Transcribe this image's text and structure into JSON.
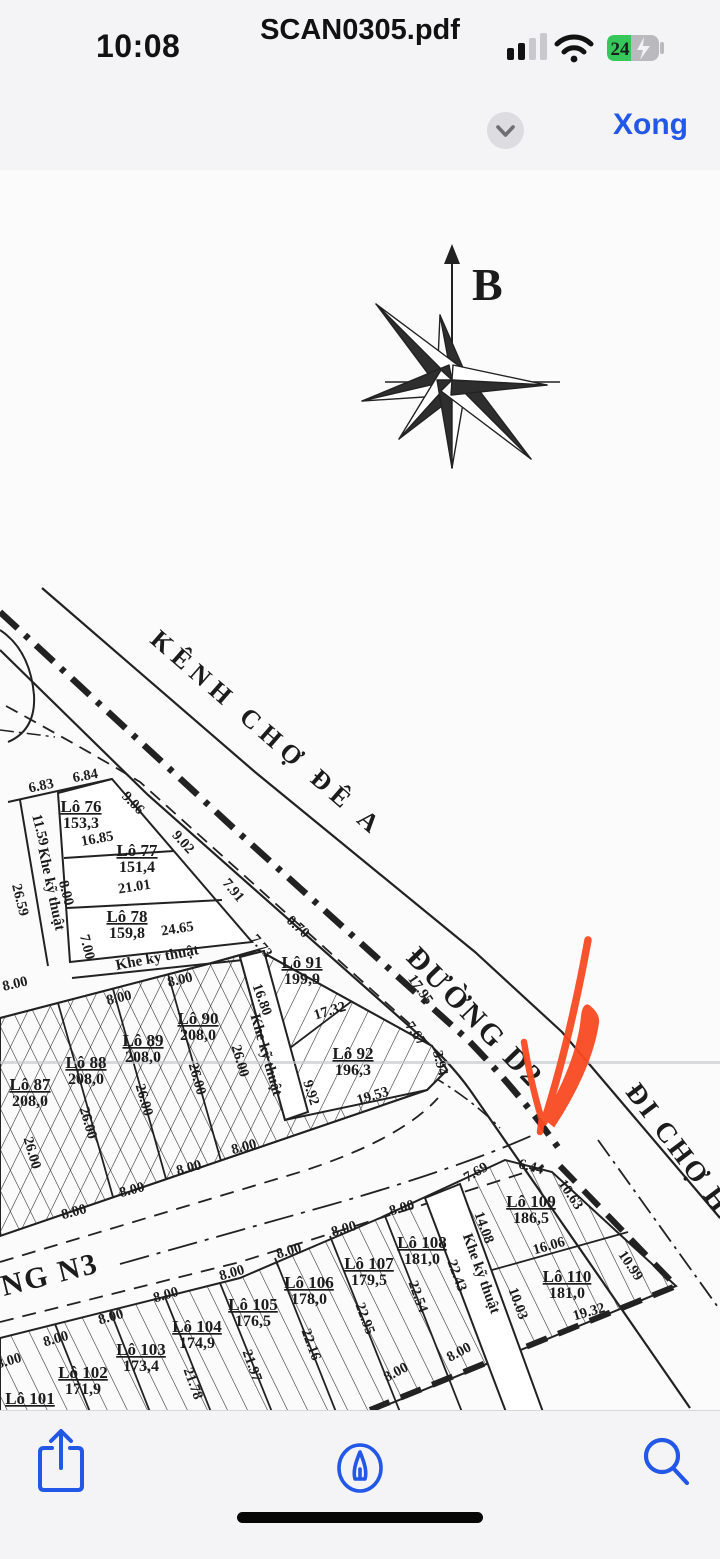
{
  "status_bar": {
    "time": "10:08",
    "battery_percent": "24"
  },
  "nav": {
    "title": "SCAN0305.pdf",
    "done_label": "Xong"
  },
  "page_indicator": {
    "label": "1 / 1"
  },
  "icons": {
    "accent_blue": "#2257e7",
    "arrow_red": "#f84b22",
    "names": [
      "sidebar-pages-icon",
      "chevron-down-icon",
      "share-icon",
      "markup-pen-icon",
      "search-icon"
    ]
  },
  "map": {
    "north": "B",
    "roads": [
      {
        "t": "KÊNH CHỢ ĐÊ A",
        "x": 262,
        "y": 740,
        "r": 41,
        "s": 26,
        "ls": 7
      },
      {
        "t": "ĐƯỜNG D2",
        "x": 468,
        "y": 1024,
        "r": 46,
        "s": 30,
        "ls": 3
      },
      {
        "t": "ĐI CHỢ HA",
        "x": 678,
        "y": 1163,
        "r": 53,
        "s": 28,
        "ls": 3
      },
      {
        "t": "NG N3",
        "x": 52,
        "y": 1284,
        "r": -14,
        "s": 30,
        "ls": 2
      }
    ],
    "plots": [
      {
        "name": "Lô 76",
        "area": "153,3",
        "x": 81,
        "y": 812
      },
      {
        "name": "Lô 77",
        "area": "151,4",
        "x": 137,
        "y": 856
      },
      {
        "name": "Lô 78",
        "area": "159,8",
        "x": 127,
        "y": 922
      },
      {
        "name": "Lô 87",
        "area": "208,0",
        "x": 30,
        "y": 1090
      },
      {
        "name": "Lô 88",
        "area": "208,0",
        "x": 86,
        "y": 1068
      },
      {
        "name": "Lô 89",
        "area": "208,0",
        "x": 143,
        "y": 1046
      },
      {
        "name": "Lô 90",
        "area": "208,0",
        "x": 198,
        "y": 1024
      },
      {
        "name": "Lô 91",
        "area": "199,9",
        "x": 302,
        "y": 968
      },
      {
        "name": "Lô 92",
        "area": "196,3",
        "x": 353,
        "y": 1059
      },
      {
        "name": "Lô 101",
        "area": "",
        "x": 30,
        "y": 1404
      },
      {
        "name": "Lô 102",
        "area": "171,9",
        "x": 83,
        "y": 1378
      },
      {
        "name": "Lô 103",
        "area": "173,4",
        "x": 141,
        "y": 1355
      },
      {
        "name": "Lô 104",
        "area": "174,9",
        "x": 197,
        "y": 1332
      },
      {
        "name": "Lô 105",
        "area": "176,5",
        "x": 253,
        "y": 1310
      },
      {
        "name": "Lô 106",
        "area": "178,0",
        "x": 309,
        "y": 1288
      },
      {
        "name": "Lô 107",
        "area": "179,5",
        "x": 369,
        "y": 1269
      },
      {
        "name": "Lô 108",
        "area": "181,0",
        "x": 422,
        "y": 1248
      },
      {
        "name": "Lô 109",
        "area": "186,5",
        "x": 531,
        "y": 1207
      },
      {
        "name": "Lô 110",
        "area": "181,0",
        "x": 567,
        "y": 1282
      }
    ],
    "khe": [
      {
        "t": "Khe kỹ thuật",
        "x": 47,
        "y": 890,
        "r": 78
      },
      {
        "t": "Khe kỹ thuật",
        "x": 158,
        "y": 962,
        "r": -11
      },
      {
        "t": "Khe kỹ thuật",
        "x": 262,
        "y": 1056,
        "r": 74
      },
      {
        "t": "Khe kỹ thuật",
        "x": 477,
        "y": 1275,
        "r": 70
      }
    ],
    "dims": [
      {
        "t": "6.83",
        "x": 42,
        "y": 790,
        "r": -12
      },
      {
        "t": "6.84",
        "x": 86,
        "y": 780,
        "r": -10
      },
      {
        "t": "9.06",
        "x": 130,
        "y": 806,
        "r": 46
      },
      {
        "t": "11.59",
        "x": 36,
        "y": 831,
        "r": 76
      },
      {
        "t": "16.85",
        "x": 98,
        "y": 843,
        "r": -10
      },
      {
        "t": "9.02",
        "x": 180,
        "y": 845,
        "r": 48
      },
      {
        "t": "21.01",
        "x": 135,
        "y": 891,
        "r": -9
      },
      {
        "t": "8.00",
        "x": 62,
        "y": 894,
        "r": 76
      },
      {
        "t": "26.59",
        "x": 16,
        "y": 901,
        "r": 76
      },
      {
        "t": "7.91",
        "x": 230,
        "y": 893,
        "r": 50
      },
      {
        "t": "24.65",
        "x": 178,
        "y": 933,
        "r": -9
      },
      {
        "t": "7.00",
        "x": 83,
        "y": 948,
        "r": 76
      },
      {
        "t": "0.70",
        "x": 295,
        "y": 930,
        "r": 42
      },
      {
        "t": "7.73",
        "x": 258,
        "y": 949,
        "r": 50
      },
      {
        "t": "16.80",
        "x": 258,
        "y": 1001,
        "r": 70
      },
      {
        "t": "17.95",
        "x": 417,
        "y": 992,
        "r": 55
      },
      {
        "t": "17.32",
        "x": 331,
        "y": 1015,
        "r": -17
      },
      {
        "t": "7.67",
        "x": 412,
        "y": 1036,
        "r": 55
      },
      {
        "t": "3.94",
        "x": 436,
        "y": 1064,
        "r": 76
      },
      {
        "t": "19.53",
        "x": 374,
        "y": 1100,
        "r": -17
      },
      {
        "t": "9.92",
        "x": 307,
        "y": 1094,
        "r": 72
      },
      {
        "t": "8.00",
        "x": 16,
        "y": 988,
        "r": -13
      },
      {
        "t": "8.00",
        "x": 120,
        "y": 1002,
        "r": -13
      },
      {
        "t": "8.00",
        "x": 181,
        "y": 984,
        "r": -13
      },
      {
        "t": "26.00",
        "x": 84,
        "y": 1124,
        "r": 74
      },
      {
        "t": "26.00",
        "x": 140,
        "y": 1101,
        "r": 74
      },
      {
        "t": "26.00",
        "x": 193,
        "y": 1080,
        "r": 74
      },
      {
        "t": "26.00",
        "x": 236,
        "y": 1062,
        "r": 74
      },
      {
        "t": "26.00",
        "x": 28,
        "y": 1154,
        "r": 74
      },
      {
        "t": "8.00",
        "x": 75,
        "y": 1216,
        "r": -15
      },
      {
        "t": "8.00",
        "x": 133,
        "y": 1194,
        "r": -15
      },
      {
        "t": "8.00",
        "x": 190,
        "y": 1172,
        "r": -15
      },
      {
        "t": "8.00",
        "x": 245,
        "y": 1151,
        "r": -15
      },
      {
        "t": "8.00",
        "x": 403,
        "y": 1212,
        "r": -16
      },
      {
        "t": "8.00",
        "x": 345,
        "y": 1233,
        "r": -16
      },
      {
        "t": "8.00",
        "x": 290,
        "y": 1255,
        "r": -16
      },
      {
        "t": "8.00",
        "x": 233,
        "y": 1277,
        "r": -16
      },
      {
        "t": "8.00",
        "x": 167,
        "y": 1299,
        "r": -16
      },
      {
        "t": "8.00",
        "x": 112,
        "y": 1321,
        "r": -16
      },
      {
        "t": "8.00",
        "x": 57,
        "y": 1343,
        "r": -16
      },
      {
        "t": "8.00",
        "x": 10,
        "y": 1365,
        "r": -16
      },
      {
        "t": "7.69",
        "x": 478,
        "y": 1176,
        "r": -30
      },
      {
        "t": "6.44",
        "x": 530,
        "y": 1171,
        "r": 14
      },
      {
        "t": "10.63",
        "x": 567,
        "y": 1197,
        "r": 56
      },
      {
        "t": "14.08",
        "x": 480,
        "y": 1229,
        "r": 70
      },
      {
        "t": "16.06",
        "x": 550,
        "y": 1250,
        "r": -16
      },
      {
        "t": "10.99",
        "x": 627,
        "y": 1268,
        "r": 56
      },
      {
        "t": "10.03",
        "x": 514,
        "y": 1305,
        "r": 70
      },
      {
        "t": "19.32",
        "x": 590,
        "y": 1316,
        "r": -16
      },
      {
        "t": "22.43",
        "x": 453,
        "y": 1277,
        "r": 70
      },
      {
        "t": "22.54",
        "x": 414,
        "y": 1298,
        "r": 70
      },
      {
        "t": "22.95",
        "x": 361,
        "y": 1320,
        "r": 70
      },
      {
        "t": "22.16",
        "x": 307,
        "y": 1346,
        "r": 70
      },
      {
        "t": "21.97",
        "x": 248,
        "y": 1367,
        "r": 70
      },
      {
        "t": "21.78",
        "x": 189,
        "y": 1385,
        "r": 70
      },
      {
        "t": "8.00",
        "x": 398,
        "y": 1376,
        "r": -28
      },
      {
        "t": "8.00",
        "x": 461,
        "y": 1356,
        "r": -28
      }
    ]
  }
}
